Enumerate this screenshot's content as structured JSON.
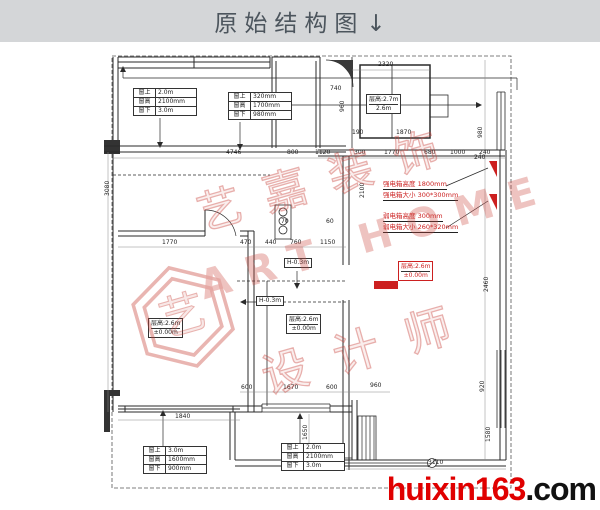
{
  "header": {
    "title": "原始结构图",
    "arrow": "↓"
  },
  "colors": {
    "red": "#cc2020",
    "logo_red": "#e00000",
    "watermark": "#c9473f",
    "header_bg": "#d4d6d8"
  },
  "watermark": {
    "brand": "艺嘉装饰",
    "latin": "ART HOME",
    "role": "设计师",
    "seal_char": "艺"
  },
  "logo": {
    "name": "huixin163",
    "tld": ".com"
  },
  "plan": {
    "dims": [
      {
        "x": 378,
        "y": 62,
        "t": "2320"
      },
      {
        "x": 330,
        "y": 86,
        "t": "740"
      },
      {
        "x": 340,
        "y": 112,
        "t": "960",
        "v": 1
      },
      {
        "x": 352,
        "y": 130,
        "t": "190"
      },
      {
        "x": 396,
        "y": 130,
        "t": "1870"
      },
      {
        "x": 360,
        "y": 198,
        "t": "2100",
        "v": 1
      },
      {
        "x": 478,
        "y": 138,
        "t": "980",
        "v": 1
      },
      {
        "x": 474,
        "y": 155,
        "t": "240"
      },
      {
        "x": 484,
        "y": 292,
        "t": "2460",
        "v": 1
      },
      {
        "x": 480,
        "y": 392,
        "t": "920",
        "v": 1
      },
      {
        "x": 486,
        "y": 442,
        "t": "1580",
        "v": 1
      },
      {
        "x": 226,
        "y": 150,
        "t": "4746"
      },
      {
        "x": 287,
        "y": 150,
        "t": "800"
      },
      {
        "x": 315,
        "y": 150,
        "t": "1120"
      },
      {
        "x": 354,
        "y": 150,
        "t": "300"
      },
      {
        "x": 384,
        "y": 150,
        "t": "1770"
      },
      {
        "x": 424,
        "y": 150,
        "t": "680"
      },
      {
        "x": 450,
        "y": 150,
        "t": "1000"
      },
      {
        "x": 479,
        "y": 150,
        "t": "240"
      },
      {
        "x": 162,
        "y": 240,
        "t": "1770"
      },
      {
        "x": 240,
        "y": 240,
        "t": "470"
      },
      {
        "x": 265,
        "y": 240,
        "t": "440"
      },
      {
        "x": 290,
        "y": 240,
        "t": "760"
      },
      {
        "x": 320,
        "y": 240,
        "t": "1150"
      },
      {
        "x": 281,
        "y": 219,
        "t": "70"
      },
      {
        "x": 326,
        "y": 219,
        "t": "60"
      },
      {
        "x": 241,
        "y": 385,
        "t": "600"
      },
      {
        "x": 283,
        "y": 385,
        "t": "1670"
      },
      {
        "x": 326,
        "y": 385,
        "t": "600"
      },
      {
        "x": 370,
        "y": 383,
        "t": "960"
      },
      {
        "x": 175,
        "y": 414,
        "t": "1840"
      },
      {
        "x": 428,
        "y": 460,
        "t": "3110"
      },
      {
        "x": 105,
        "y": 196,
        "t": "3080",
        "v": 1
      },
      {
        "x": 303,
        "y": 440,
        "t": "1650",
        "v": 1
      }
    ],
    "window_tables": [
      {
        "x": 133,
        "y": 88,
        "rows": [
          [
            "窗上",
            "2.0m"
          ],
          [
            "窗高",
            "2100mm"
          ],
          [
            "窗下",
            "3.0m"
          ]
        ]
      },
      {
        "x": 228,
        "y": 92,
        "rows": [
          [
            "窗上",
            "320mm"
          ],
          [
            "窗高",
            "1700mm"
          ],
          [
            "窗下",
            "980mm"
          ]
        ]
      },
      {
        "x": 143,
        "y": 446,
        "rows": [
          [
            "窗上",
            "3.0m"
          ],
          [
            "窗高",
            "1600mm"
          ],
          [
            "窗下",
            "900mm"
          ]
        ]
      },
      {
        "x": 281,
        "y": 443,
        "rows": [
          [
            "窗上",
            "2.0m"
          ],
          [
            "窗高",
            "2100mm"
          ],
          [
            "窗下",
            "3.0m"
          ]
        ]
      }
    ],
    "height_boxes": [
      {
        "x": 366,
        "y": 94,
        "l1": "层高:2.7m",
        "l2": "2.6m",
        "red": false
      },
      {
        "x": 148,
        "y": 318,
        "l1": "层高:2.6m",
        "l2": "±0.00m",
        "red": false
      },
      {
        "x": 286,
        "y": 314,
        "l1": "层高:2.6m",
        "l2": "±0.00m",
        "red": false
      },
      {
        "x": 398,
        "y": 261,
        "l1": "层高:2.6m",
        "l2": "±0.00m",
        "red": true
      }
    ],
    "level_notes": [
      {
        "x": 284,
        "y": 258,
        "t": "H-0.3m"
      },
      {
        "x": 256,
        "y": 296,
        "t": "H-0.3m"
      }
    ],
    "panel_notes": [
      {
        "x": 383,
        "y": 181,
        "t": "强电箱高度 1800mm"
      },
      {
        "x": 383,
        "y": 192,
        "t": "强电箱大小 300*300mm"
      },
      {
        "x": 383,
        "y": 213,
        "t": "弱电箱高度 300mm"
      },
      {
        "x": 383,
        "y": 224,
        "t": "弱电箱大小 260*320mm"
      }
    ]
  }
}
